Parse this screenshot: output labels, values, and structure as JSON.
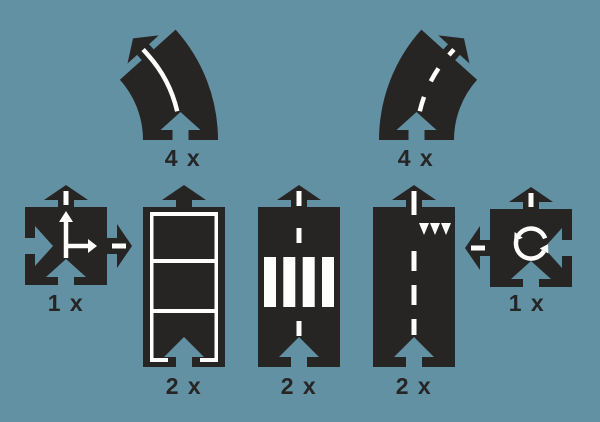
{
  "palette": {
    "background": "#6291a3",
    "piece": "#272424",
    "marking": "#fdfdfb"
  },
  "pieces": [
    {
      "name": "curved-road-solid-line",
      "label": "4 x"
    },
    {
      "name": "curved-road-dashed-line",
      "label": "4 x"
    },
    {
      "name": "t-junction-connector",
      "label": "1 x"
    },
    {
      "name": "straight-road-lane-grid",
      "label": "2 x"
    },
    {
      "name": "straight-road-zebra-crossing",
      "label": "2 x"
    },
    {
      "name": "straight-road-dashed-yield",
      "label": "2 x"
    },
    {
      "name": "roundabout-connector",
      "label": "1 x"
    }
  ]
}
